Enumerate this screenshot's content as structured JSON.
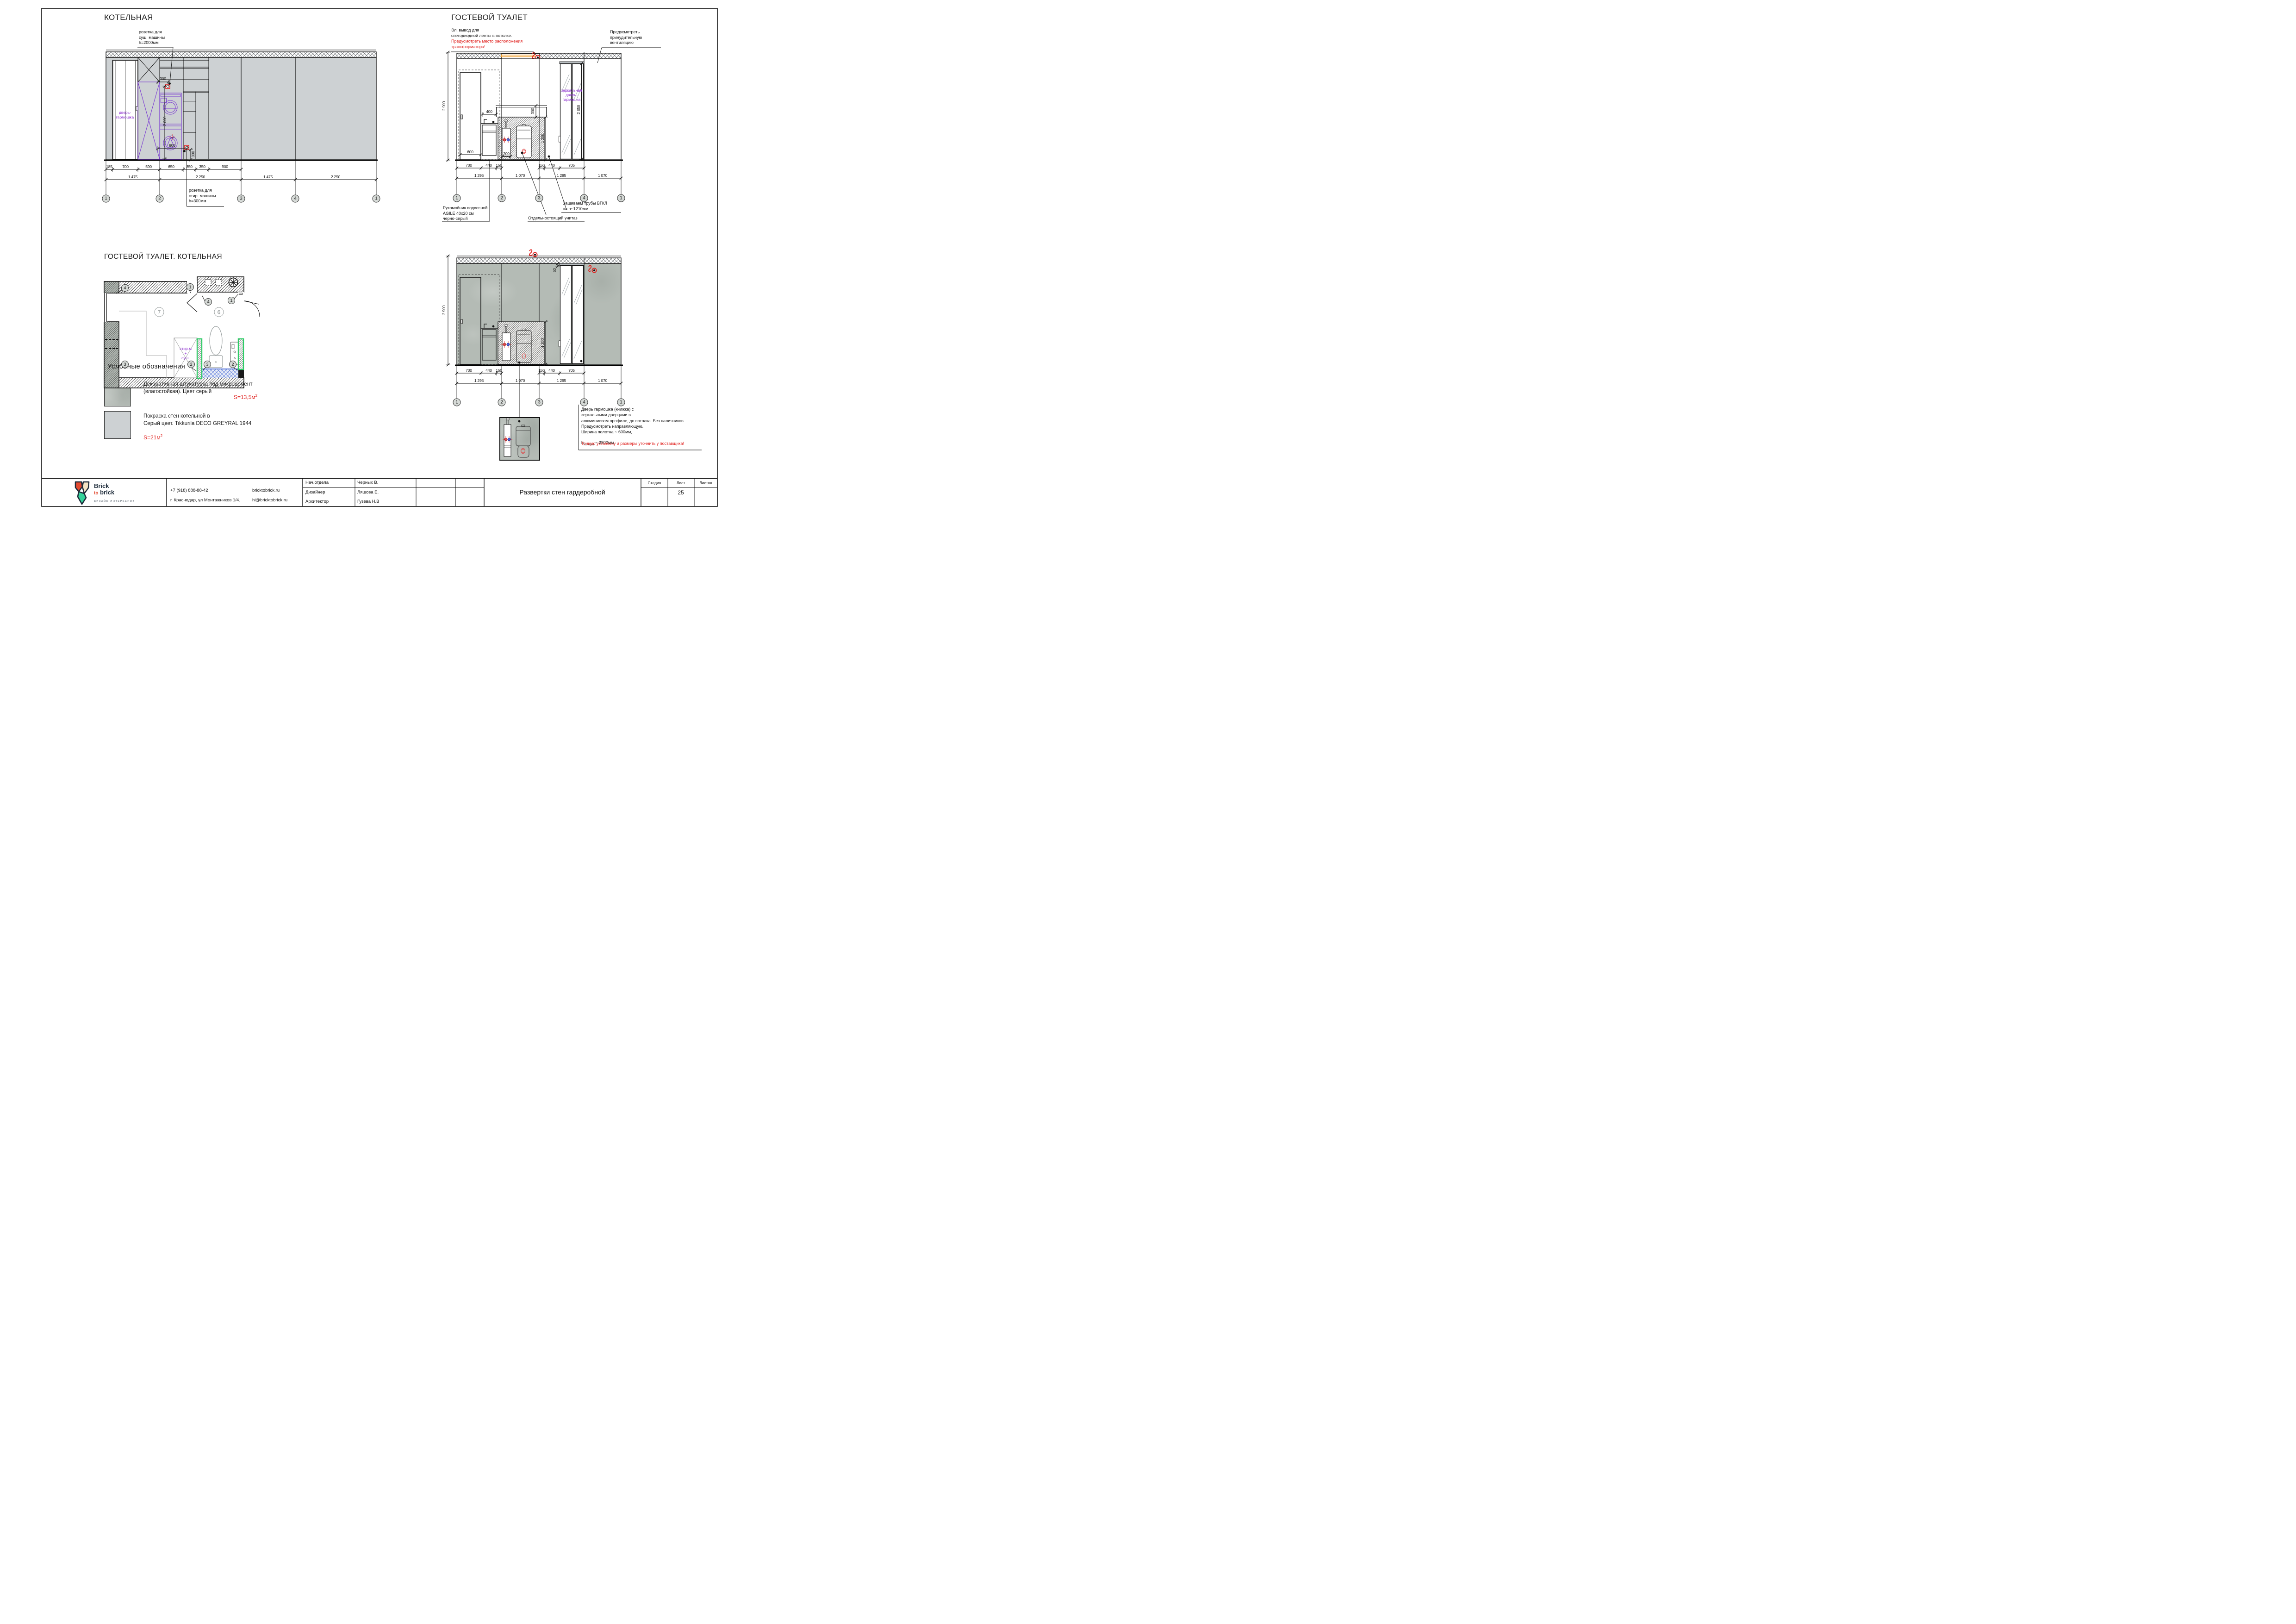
{
  "titles": {
    "boiler": "КОТЕЛЬНАЯ",
    "guest_wc": "ГОСТЕВОЙ ТУАЛЕТ",
    "plan": "ГОСТЕВОЙ ТУАЛЕТ. КОТЕЛЬНАЯ",
    "legend": "Условные обозначения"
  },
  "boiler": {
    "note_dryer": "розетка для\nсуш. машины\nh=2000мм",
    "note_washer": "розетка для\nстир. машины\nh=300мм",
    "door_label": "дверь-\nгармошка",
    "dim_300_top": "300",
    "dim_2000": "2 000",
    "dim_800": "800",
    "dim_300_bottom": "300",
    "dims_detail": [
      "185",
      "700",
      "590",
      "650",
      "350",
      "350",
      "900"
    ],
    "dims_grid": [
      "1 475",
      "2 250",
      "1 475",
      "2 250"
    ],
    "bubbles": [
      "1",
      "2",
      "3",
      "4",
      "1"
    ]
  },
  "wc": {
    "note_led": "Эл. вывод для\nсветодиодной ленты в потолке.",
    "note_led_red": "Предусмотреть место расположения\nтрансформатора!",
    "note_vent": "Предусмотреть\nпринудительную\nвентиляцию",
    "mirror_label": "зеркальная\nдверь-\nгармошка",
    "dim_2900": "2 900",
    "dim_2850": "2 850",
    "dim_600": "600",
    "dim_400": "400",
    "dim_300": "300",
    "dim_1200": "1 200",
    "dim_200": "200",
    "dim_50": "50",
    "dims_detail_left": [
      "700",
      "440",
      "150"
    ],
    "dims_detail_right": [
      "150",
      "440",
      "705"
    ],
    "dims_grid": [
      "1 295",
      "1 070",
      "1 295",
      "1 070"
    ],
    "bubbles": [
      "1",
      "2",
      "3",
      "4",
      "1"
    ],
    "note_sink": "Рукомойник подвесной\nAGILE 40x20 см\nчерно-серый",
    "note_wc": "Отдельностоящий унитаз",
    "note_pipes": "Зашиваем трубы ВГКЛ\nна h~1210мм"
  },
  "wardrobe": {
    "door_note": "Дверь гармошка (книжка) с\nзеркальными дверцами в\nалюминиевом профиле, до потолка. Без наличников\nПредусмотреть направляющую.\nШирина полотна ~ 600мм,",
    "door_note_h_prefix": "h",
    "door_note_h_sub": "полотна",
    "door_note_h_suffix": " ~ 2800мм",
    "door_note_red": "Точную установку и размеры уточнить у поставщика!"
  },
  "plan": {
    "machines": "стир.м\n+\nсуш.",
    "room7": "7",
    "room6": "6",
    "m1": "1",
    "m2": "2",
    "m3": "3",
    "m4": "4"
  },
  "legend": {
    "item1_text": "Декоративная штукатурка под микроцемент\n(влагостойкая). Цвет серый",
    "item1_area": "S=13,5м",
    "item1_sup": "2",
    "item2_text": "Покраска стен котельной  в\nСерый цвет. Tikkurila DECO GREYRAL 1944",
    "item2_area": "S=21м",
    "item2_sup": "2"
  },
  "titleblock": {
    "brand_line1": "Brick",
    "brand_to": "to",
    "brand_line2": "brick",
    "brand_sub": "ДИЗАЙН ИНТЕРЬЕРОВ",
    "phone": "+7 (918)  888-88-42",
    "address": "г. Краснодар, ул Монтажников 1/4.",
    "site": "bricktobrick.ru",
    "email": "hi@bricktobrick.ru",
    "rows": [
      {
        "role": "Нач.отдела",
        "name": "Черных В."
      },
      {
        "role": "Дизайнер",
        "name": "Ляшова Е."
      },
      {
        "role": "Архитектор",
        "name": "Гузева Н.В"
      }
    ],
    "doc_title": "Развертки стен гардеробной",
    "stage": "Стадия",
    "sheet": "Лист",
    "sheets": "Листов",
    "sheet_num": "25"
  }
}
